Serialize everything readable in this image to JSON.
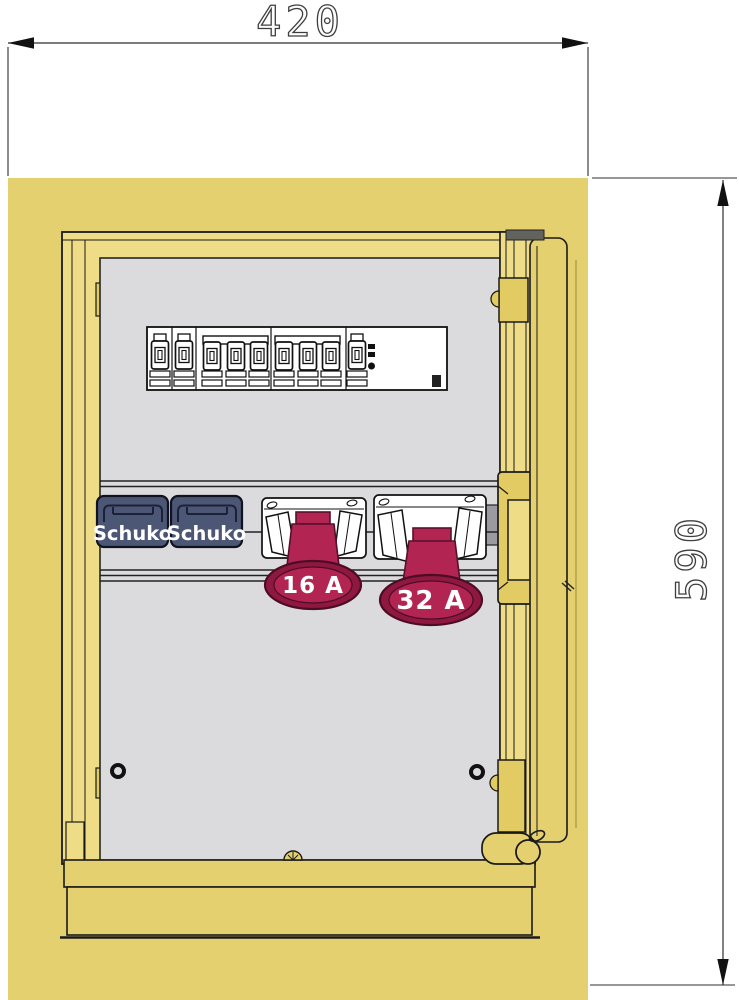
{
  "dimensions": {
    "width_label": "420",
    "height_label": "590"
  },
  "sockets": {
    "schuko1_label": "Schuko",
    "schuko2_label": "Schuko",
    "cee16_label": "16 A",
    "cee32_label": "32 A"
  },
  "devices": {
    "breaker_row": [
      "breaker-1p",
      "breaker-1p",
      "breaker-3p",
      "breaker-3p",
      "rcd"
    ]
  },
  "colors": {
    "enclosure": "#e5d06f",
    "frame": "#eedc86",
    "hinge": "#e2cb63",
    "panel": "#dbdbdd",
    "rail_end": "#9a9aa0",
    "schuko_body": "#4c5675",
    "cee_red": "#b22452",
    "cee_red_dark": "#8e1840",
    "housing_white": "#ffffff",
    "cap_gray": "#63635e",
    "line": "#1a1a1a",
    "dim_line": "#2f2f2f"
  }
}
